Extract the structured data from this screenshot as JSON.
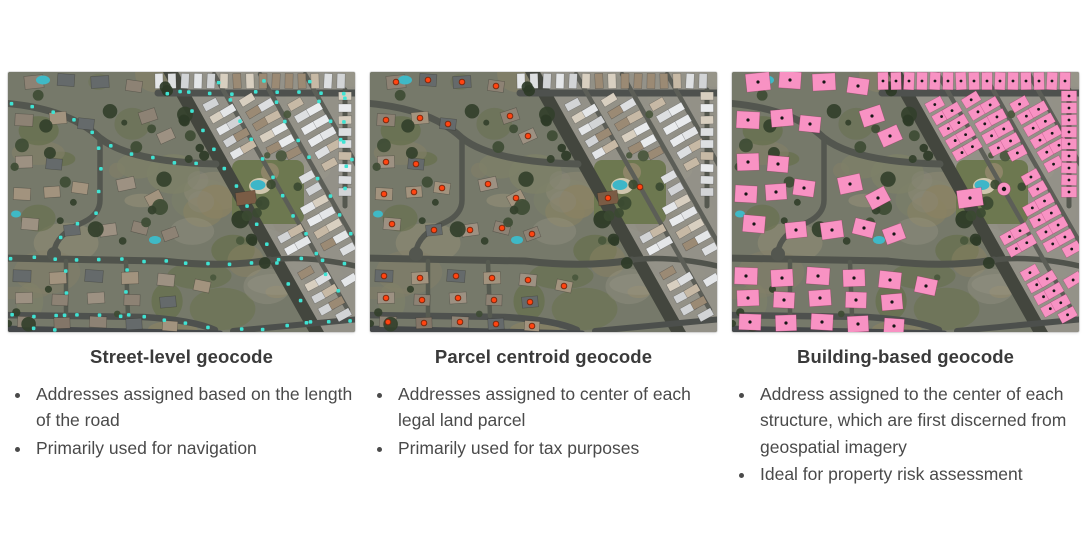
{
  "figure_alt": "Three identical aerial satellite views of a suburban neighborhood beside a mobile home park, each annotated with a different geocoding method",
  "panels": [
    {
      "id": "street-level",
      "title": "Street-level geocode",
      "bullets": [
        "Addresses assigned based on the length of the road",
        "Primarily used for navigation"
      ],
      "overlay": {
        "type": "road-dots",
        "marker": "cyan-square-dot",
        "color": "#3fe3d3",
        "description": "evenly spaced cyan dots along every road"
      }
    },
    {
      "id": "parcel-centroid",
      "title": "Parcel centroid geocode",
      "bullets": [
        "Addresses assigned to center of each legal land parcel",
        "Primarily used for tax purposes"
      ],
      "overlay": {
        "type": "centroid-dots",
        "marker": "orange-circle-dot",
        "color": "#ff4411",
        "outline": "#7c2a10",
        "description": "red-orange dots at the center of each land parcel"
      }
    },
    {
      "id": "building-based",
      "title": "Building-based geocode",
      "bullets": [
        "Address assigned to the center of each structure, which are first discerned from geospatial imagery",
        "Ideal for property risk assessment"
      ],
      "overlay": {
        "type": "building-footprints",
        "marker": "pink-footprint-polygon",
        "color": "#f892c3",
        "dot_color": "#161616",
        "description": "pink building footprint polygons with black center dots"
      }
    }
  ]
}
